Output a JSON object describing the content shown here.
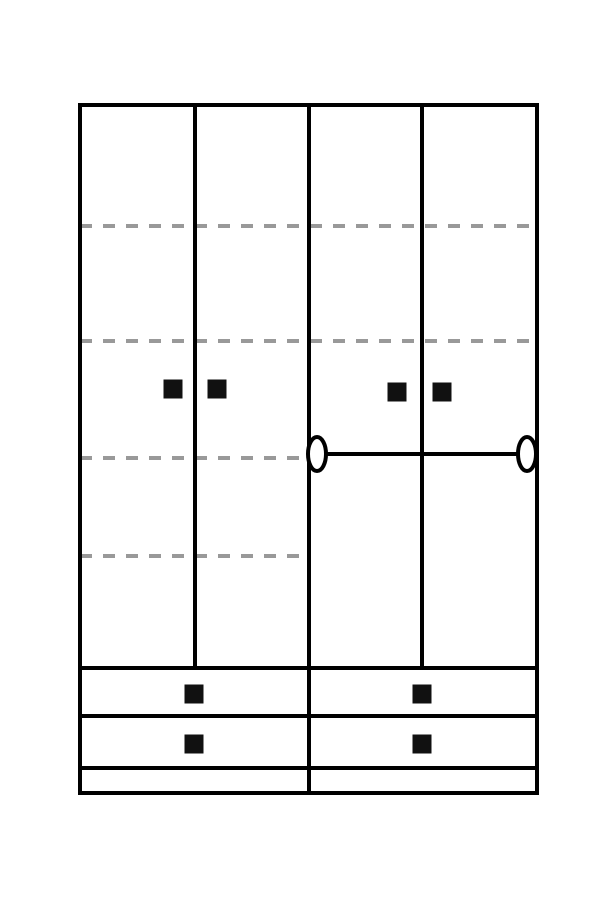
{
  "canvas": {
    "width": 600,
    "height": 900,
    "background": "#ffffff"
  },
  "colors": {
    "outline": "#000000",
    "shelf_dashed": "#999999",
    "handle": "#111111",
    "fill": "#ffffff"
  },
  "wardrobe": {
    "outer": {
      "x": 80,
      "y": 105,
      "w": 457,
      "h": 688,
      "stroke": 4
    },
    "divider_stroke": 4,
    "door_dividers": [
      {
        "name": "door-divider-left",
        "x": 195,
        "y1": 105,
        "y2": 668
      },
      {
        "name": "door-divider-center",
        "x": 309,
        "y1": 105,
        "y2": 793
      },
      {
        "name": "door-divider-right",
        "x": 422,
        "y1": 105,
        "y2": 668
      }
    ],
    "dash_pattern": {
      "dash": 12,
      "gap": 11,
      "thickness": 4
    },
    "shelves_dashed": [
      {
        "y": 226,
        "x1": 80,
        "x2": 537
      },
      {
        "y": 341,
        "x1": 80,
        "x2": 537
      },
      {
        "y": 458,
        "x1": 80,
        "x2": 307
      },
      {
        "y": 556,
        "x1": 80,
        "x2": 307
      }
    ],
    "hanging_rod": {
      "y": 454,
      "x1": 317,
      "x2": 527,
      "end_rx": 9,
      "end_ry": 17,
      "stroke": 4
    },
    "door_handles": [
      {
        "cx": 173,
        "cy": 389,
        "size": 19
      },
      {
        "cx": 217,
        "cy": 389,
        "size": 19
      },
      {
        "cx": 397,
        "cy": 392,
        "size": 19
      },
      {
        "cx": 442,
        "cy": 392,
        "size": 19
      }
    ],
    "drawer_lines": [
      {
        "y": 668,
        "x1": 80,
        "x2": 537
      },
      {
        "y": 716,
        "x1": 80,
        "x2": 537
      },
      {
        "y": 768,
        "x1": 80,
        "x2": 537
      }
    ],
    "drawer_handles": [
      {
        "cx": 194,
        "cy": 694,
        "size": 19
      },
      {
        "cx": 194,
        "cy": 744,
        "size": 19
      },
      {
        "cx": 422,
        "cy": 694,
        "size": 19
      },
      {
        "cx": 422,
        "cy": 744,
        "size": 19
      }
    ]
  }
}
